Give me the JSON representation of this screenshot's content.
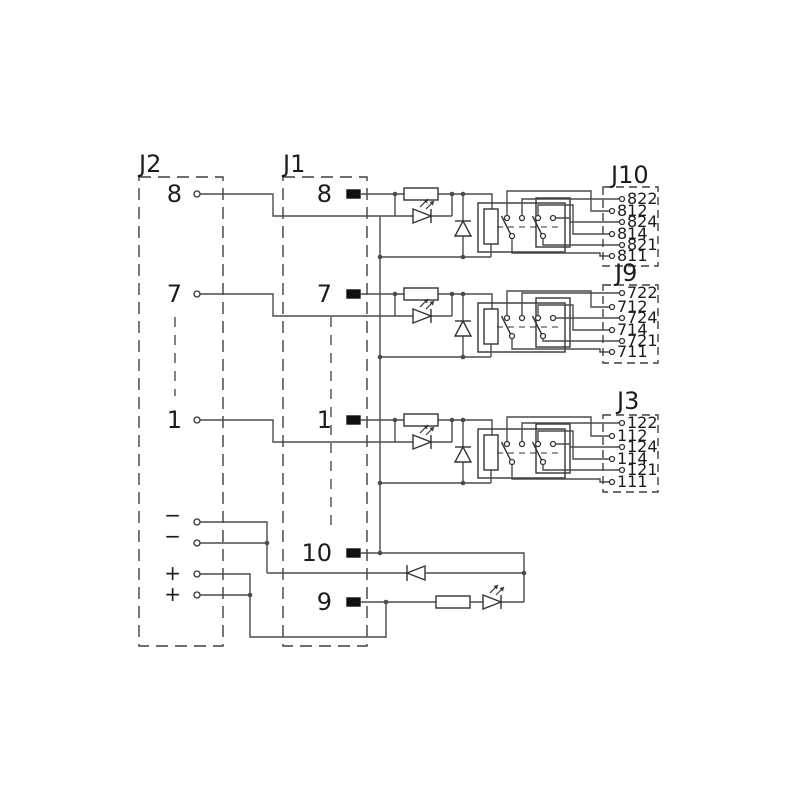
{
  "colors": {
    "background": "#ffffff",
    "wire": "#4b4b4b",
    "component": "#333333",
    "dashed_box": "#3f3f3f",
    "terminal": "#111111",
    "text": "#1c1c1c"
  },
  "connectors": {
    "j2": {
      "label": "J2",
      "signal_pins": [
        "8",
        "7",
        "1"
      ],
      "minus_pins": [
        "−",
        "−"
      ],
      "plus_pins": [
        "+",
        "+"
      ]
    },
    "j1": {
      "label": "J1",
      "signal_pins": [
        "8",
        "7",
        "1"
      ],
      "common_pin": "10",
      "power_pin": "9"
    },
    "outputs": [
      {
        "label": "J10",
        "pins": [
          "822",
          "812",
          "824",
          "814",
          "821",
          "811"
        ]
      },
      {
        "label": "J9",
        "pins": [
          "722",
          "712",
          "724",
          "714",
          "721",
          "711"
        ]
      },
      {
        "label": "J3",
        "pins": [
          "122",
          "112",
          "124",
          "114",
          "121",
          "111"
        ]
      }
    ]
  }
}
